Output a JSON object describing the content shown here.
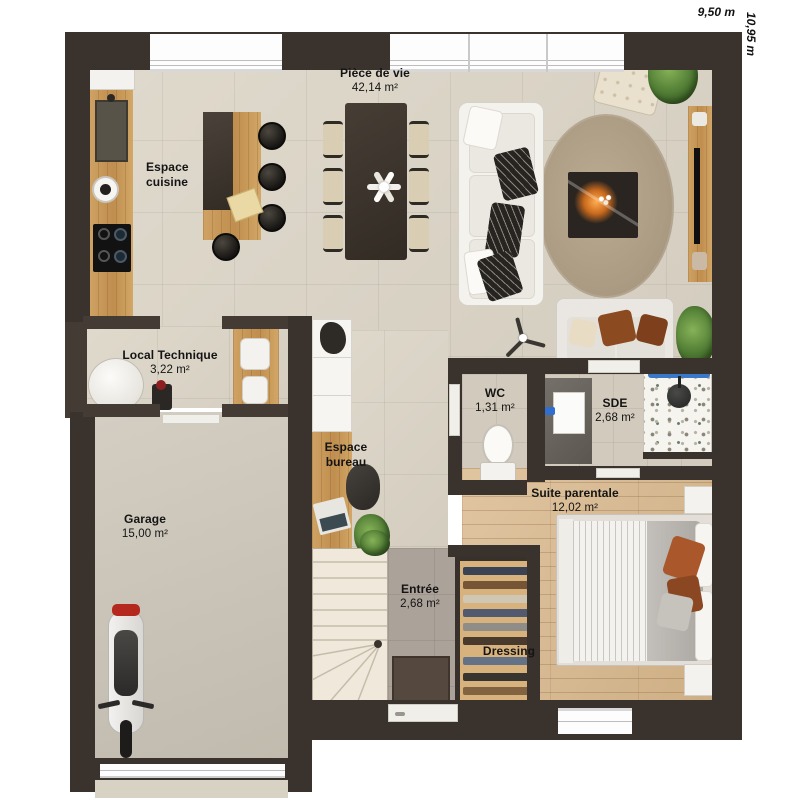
{
  "dimensions": {
    "width": "9,50 m",
    "height": "10,95 m"
  },
  "rooms": {
    "piece_de_vie": {
      "name": "Pièce de vie",
      "area": "42,14 m²"
    },
    "espace_cuisine": {
      "name": "Espace cuisine"
    },
    "local_technique": {
      "name": "Local Technique",
      "area": "3,22 m²"
    },
    "espace_bureau": {
      "name": "Espace bureau"
    },
    "garage": {
      "name": "Garage",
      "area": "15,00 m²"
    },
    "entree": {
      "name": "Entrée",
      "area": "2,68 m²"
    },
    "wc": {
      "name": "WC",
      "area": "1,31 m²"
    },
    "sde": {
      "name": "SDE",
      "area": "2,68 m²"
    },
    "suite_parentale": {
      "name": "Suite parentale",
      "area": "12,02 m²"
    },
    "dressing": {
      "name": "Dressing"
    }
  },
  "palette": {
    "wall": "#3a332d",
    "floor_living": "#dcd5c7",
    "floor_entree": "#aba29a",
    "floor_wood": "#d9b88c",
    "floor_garage": "#cbc4b7",
    "wood_furniture": "#c89b5e",
    "accent_blue": "#3a77c9",
    "accent_rust": "#8c4a20",
    "label_color": "#141414"
  }
}
